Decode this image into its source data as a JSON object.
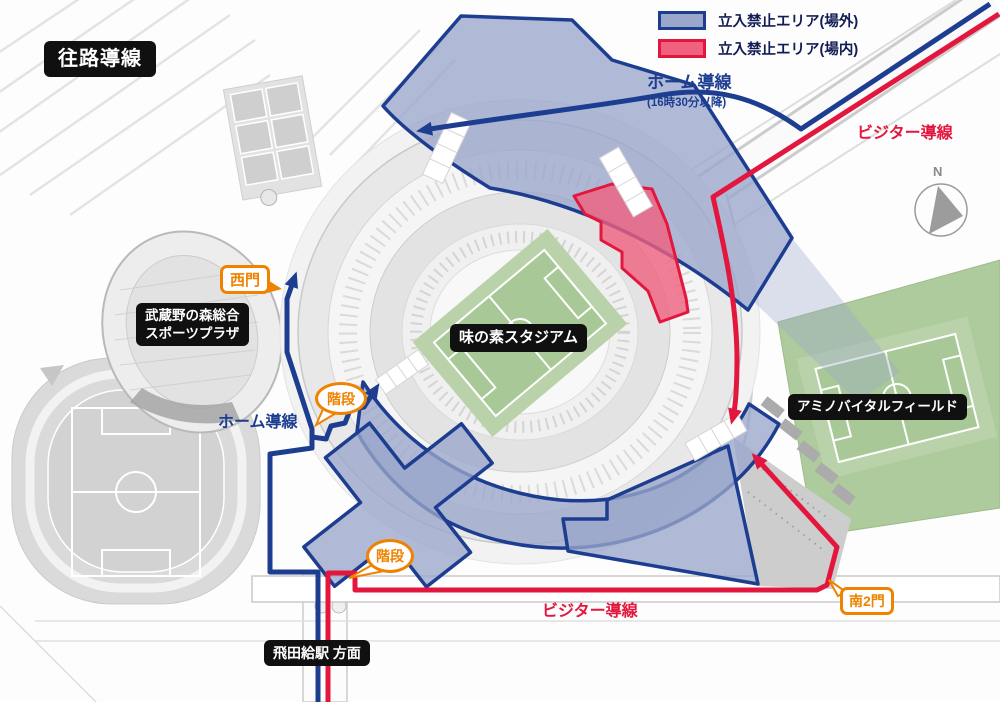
{
  "title": "往路導線",
  "legend": {
    "items": [
      {
        "label": "立入禁止エリア(場外)",
        "fill": "#9aa7cb",
        "border": "#1d3d91"
      },
      {
        "label": "立入禁止エリア(場内)",
        "fill": "#f0607f",
        "border": "#e3173e"
      }
    ]
  },
  "routes": {
    "home": {
      "label": "ホーム導線",
      "time_note": "(16時30分以降)",
      "color": "#1d3d91"
    },
    "visitor": {
      "label": "ビジター導線",
      "color": "#e3173e"
    }
  },
  "gates": {
    "west": "西門",
    "south2": "南2門"
  },
  "stairs": {
    "label": "階段"
  },
  "places": {
    "stadium": "味の素スタジアム",
    "sports_plaza_line1": "武蔵野の森総合",
    "sports_plaza_line2": "スポーツプラザ",
    "amino_vital": "アミノバイタルフィールド",
    "station": "飛田給駅 方面"
  },
  "compass": {
    "north": "N"
  },
  "colors": {
    "restricted_outside": "#9aa7cb",
    "restricted_inside": "#f0607f",
    "home_route": "#1d3d91",
    "visitor_route": "#e3173e",
    "gate_accent": "#ef8200"
  }
}
